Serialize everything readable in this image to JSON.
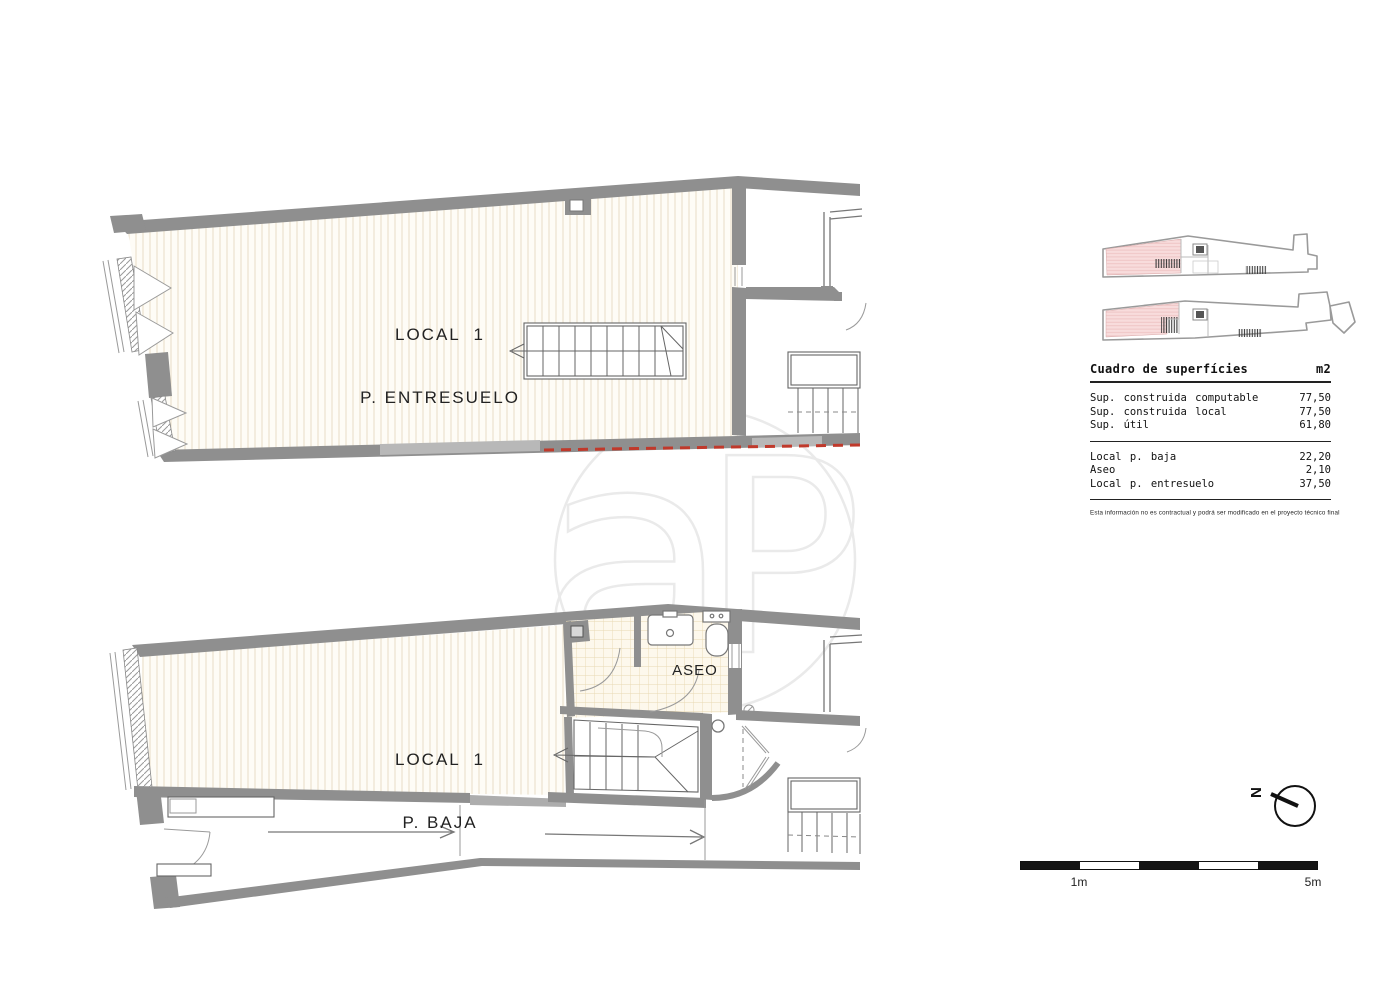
{
  "plans": {
    "entresuelo": {
      "label_line1": "LOCAL  1",
      "label_line2": "P. ENTRESUELO"
    },
    "baja": {
      "label_line1": "LOCAL  1",
      "label_line2": "P. BAJA",
      "room_label": "ASEO"
    }
  },
  "surface_table": {
    "title": "Cuadro de superfícies",
    "unit": "m2",
    "groups": [
      {
        "rows": [
          {
            "label": "Sup. construida computable",
            "value": "77,50"
          },
          {
            "label": "Sup. construida local",
            "value": "77,50"
          },
          {
            "label": "Sup. útil",
            "value": "61,80"
          }
        ]
      },
      {
        "rows": [
          {
            "label": "Local p. baja",
            "value": "22,20"
          },
          {
            "label": "Aseo",
            "value": "2,10"
          },
          {
            "label": "Local p. entresuelo",
            "value": "37,50"
          }
        ]
      }
    ],
    "disclaimer": "Esta información no es contractual y podrá ser modificado en el proyecto técnico final"
  },
  "north": {
    "label": "N"
  },
  "scale_bar": {
    "start_label": "1m",
    "end_label": "5m"
  },
  "watermark": {
    "letter_a": "a",
    "letter_p": "P"
  },
  "colors": {
    "wall_gray": "#8f8f8f",
    "floor_hatch": "#e8ddc6",
    "tile_grid": "#e8d8b2",
    "highlight_pink": "#f8dcdc",
    "red_dashed_line": "#c0392b",
    "watermark_gray": "#eaeaea"
  }
}
